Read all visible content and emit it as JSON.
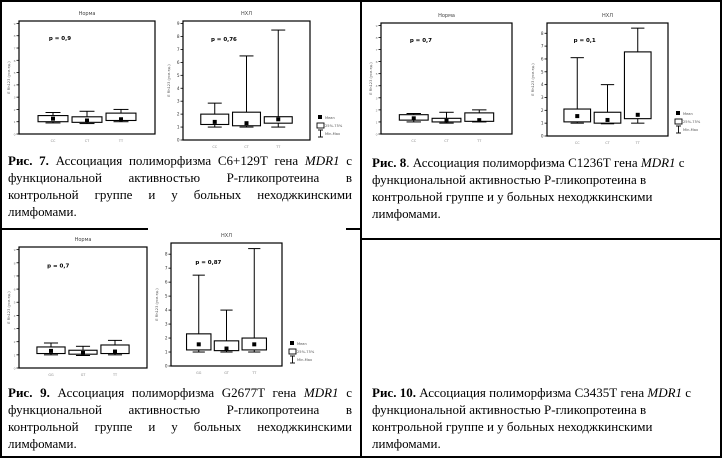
{
  "legend": {
    "mean": "Mean",
    "box": "25%-75%",
    "whisker": "Min-Max"
  },
  "figures": {
    "fig7": {
      "caption": {
        "label": "Рис. 7.",
        "before_gene": " Ассоциация полиморфизма С6+129Т  гена ",
        "gene": "MDR1",
        "after_gene": " с функциональной активностью Р-гликопротеина в контрольной группе и у больных неходжкинскими лимфомами."
      }
    },
    "fig8": {
      "caption": {
        "label": "Рис. 8",
        "before_gene": ". Ассоциация полиморфизма С1236Т гена ",
        "gene": "MDR1",
        "after_gene": " с функциональной активностью Р-гликопротеина в контрольной группе и у больных неходжкинскими лимфомами."
      }
    },
    "fig9": {
      "caption": {
        "label": "Рис. 9.",
        "before_gene": " Ассоциация полиморфизма G2677T гена ",
        "gene": "MDR1",
        "after_gene": " с функциональной активностью Р-гликопротеина в контрольной группе и у больных неходжкинскими лимфомами."
      }
    },
    "fig10": {
      "caption": {
        "label": "Рис. 10.",
        "before_gene": " Ассоциация полиморфизма С3435Т гена ",
        "gene": "MDR1",
        "after_gene": " с функциональной активностью Р-гликопротеина в контрольной группе и у больных неходжкинскими лимфомами."
      }
    }
  },
  "chart_data": [
    {
      "id": "fig7-norma",
      "type": "boxplot",
      "title": "Норма",
      "p_label": "p = 0,9",
      "ylabel": "Е Rh123 (усл.ед.)",
      "ylim": [
        0,
        9.2
      ],
      "yticks": [
        0,
        1,
        2,
        3,
        4,
        5,
        6,
        7,
        8,
        9
      ],
      "big_yticks": false,
      "legend": false,
      "categories": [
        "СС",
        "СТ",
        "ТТ"
      ],
      "boxes": [
        {
          "min": 0.9,
          "q1": 1.0,
          "mean": 1.25,
          "q3": 1.5,
          "max": 1.75
        },
        {
          "min": 0.85,
          "q1": 0.95,
          "mean": 1.1,
          "q3": 1.4,
          "max": 1.85
        },
        {
          "min": 1.0,
          "q1": 1.1,
          "mean": 1.2,
          "q3": 1.7,
          "max": 2.0
        }
      ]
    },
    {
      "id": "fig7-nhl",
      "type": "boxplot",
      "title": "НХЛ",
      "p_label": "p = 0,76",
      "ylabel": "Е Rh123 (усл.ед.)",
      "ylim": [
        0,
        9.2
      ],
      "yticks": [
        0,
        1,
        2,
        3,
        4,
        5,
        6,
        7,
        8,
        9
      ],
      "big_yticks": true,
      "legend": true,
      "categories": [
        "СС",
        "СТ",
        "ТТ"
      ],
      "boxes": [
        {
          "min": 1.0,
          "q1": 1.2,
          "mean": 1.4,
          "q3": 2.0,
          "max": 2.85
        },
        {
          "min": 1.0,
          "q1": 1.1,
          "mean": 1.3,
          "q3": 2.15,
          "max": 6.5
        },
        {
          "min": 1.0,
          "q1": 1.3,
          "mean": 1.6,
          "q3": 1.8,
          "max": 8.5
        }
      ]
    },
    {
      "id": "fig8-norma",
      "type": "boxplot",
      "title": "Норма",
      "p_label": "p = 0,7",
      "ylabel": "Е Rh123 (усл.ед.)",
      "ylim": [
        0,
        9.2
      ],
      "yticks": [
        0,
        1,
        2,
        3,
        4,
        5,
        6,
        7,
        8,
        9
      ],
      "big_yticks": false,
      "legend": false,
      "categories": [
        "СС",
        "СТ",
        "ТТ"
      ],
      "boxes": [
        {
          "min": 1.0,
          "q1": 1.15,
          "mean": 1.3,
          "q3": 1.6,
          "max": 1.7
        },
        {
          "min": 0.9,
          "q1": 1.0,
          "mean": 1.1,
          "q3": 1.3,
          "max": 1.8
        },
        {
          "min": 1.0,
          "q1": 1.05,
          "mean": 1.15,
          "q3": 1.75,
          "max": 2.0
        }
      ]
    },
    {
      "id": "fig8-nhl",
      "type": "boxplot",
      "title": "НХЛ",
      "p_label": "p = 0,1",
      "ylabel": "Е Rh123 (усл.ед.)",
      "ylim": [
        0,
        8.8
      ],
      "yticks": [
        0,
        1,
        2,
        3,
        4,
        5,
        6,
        7,
        8
      ],
      "big_yticks": true,
      "legend": true,
      "categories": [
        "СС",
        "СТ",
        "ТТ"
      ],
      "boxes": [
        {
          "min": 1.0,
          "q1": 1.1,
          "mean": 1.55,
          "q3": 2.1,
          "max": 6.1
        },
        {
          "min": 0.95,
          "q1": 1.0,
          "mean": 1.25,
          "q3": 1.85,
          "max": 4.0
        },
        {
          "min": 1.0,
          "q1": 1.35,
          "mean": 1.65,
          "q3": 6.55,
          "max": 8.4
        }
      ]
    },
    {
      "id": "fig9-norma",
      "type": "boxplot",
      "title": "Норма",
      "p_label": "p = 0,7",
      "ylabel": "Е Rh123 (усл.ед.)",
      "ylim": [
        0,
        9.2
      ],
      "yticks": [
        0,
        1,
        2,
        3,
        4,
        5,
        6,
        7,
        8,
        9
      ],
      "big_yticks": false,
      "legend": false,
      "categories": [
        "GG",
        "GT",
        "TT"
      ],
      "boxes": [
        {
          "min": 1.0,
          "q1": 1.1,
          "mean": 1.3,
          "q3": 1.6,
          "max": 1.9
        },
        {
          "min": 0.95,
          "q1": 1.05,
          "mean": 1.15,
          "q3": 1.35,
          "max": 1.65
        },
        {
          "min": 1.0,
          "q1": 1.1,
          "mean": 1.25,
          "q3": 1.75,
          "max": 2.1
        }
      ]
    },
    {
      "id": "fig9-nhl",
      "type": "boxplot",
      "title": "НХЛ",
      "p_label": "p = 0,87",
      "ylabel": "Е Rh123 (усл.ед.)",
      "ylim": [
        0,
        8.8
      ],
      "yticks": [
        0,
        1,
        2,
        3,
        4,
        5,
        6,
        7,
        8
      ],
      "big_yticks": true,
      "legend": true,
      "categories": [
        "GG",
        "GT",
        "TT"
      ],
      "boxes": [
        {
          "min": 1.0,
          "q1": 1.15,
          "mean": 1.55,
          "q3": 2.3,
          "max": 6.5
        },
        {
          "min": 1.0,
          "q1": 1.1,
          "mean": 1.25,
          "q3": 1.8,
          "max": 4.0
        },
        {
          "min": 1.0,
          "q1": 1.15,
          "mean": 1.55,
          "q3": 2.0,
          "max": 8.4
        }
      ]
    }
  ]
}
